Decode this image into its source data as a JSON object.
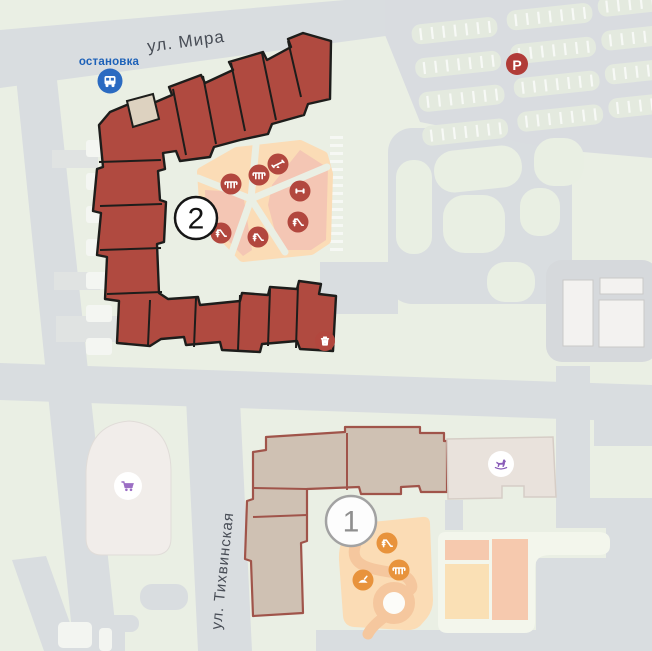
{
  "streets": {
    "mira": {
      "label": "ул. Мира"
    },
    "tikhvinskaya": {
      "label": "ул. Тихвинская"
    }
  },
  "transit": {
    "bus_stop_label": "остановка"
  },
  "parking": {
    "label": "P"
  },
  "buildings": {
    "building1": {
      "label": "1"
    },
    "building2": {
      "label": "2"
    }
  },
  "pois": {
    "bus_stop": "bus-icon",
    "parking": "parking-p-icon",
    "supermarket": "shopping-cart-icon",
    "kindergarten": "rocking-horse-icon",
    "waste": "trash-icon",
    "playground_upper": [
      "bench-icon",
      "bench-icon",
      "seesaw-icon",
      "fitness-icon",
      "slide-icon",
      "slide-icon",
      "slide-icon"
    ],
    "playground_lower": [
      "slide-icon",
      "bench-icon",
      "sandbox-icon"
    ]
  },
  "colors": {
    "background_green": "#eaefe4",
    "road_gray": "#d9dde0",
    "building2_fill": "#b04a40",
    "building2_outline": "#1d1d1b",
    "building2_annex": "#ddd2c0",
    "building1_fill": "#cfc1b3",
    "building1_outline": "#a0544a",
    "kindergarten_fill": "#e9e2dc",
    "supermarket_fill": "#f1edea",
    "white_building": "#f3f2f0",
    "playground_cream": "#fbdcb6",
    "playground_pink": "#f4c6b4",
    "playground_path": "#f5c79e",
    "icon_red": "#b2473e",
    "icon_orange": "#e8933c",
    "accent_blue": "#2b6ac1",
    "accent_purple": "#8a5cb8",
    "parking_row_green": "#e4eadf",
    "court_pink": "#f6c9ae",
    "court_cream": "#fae0b5"
  }
}
